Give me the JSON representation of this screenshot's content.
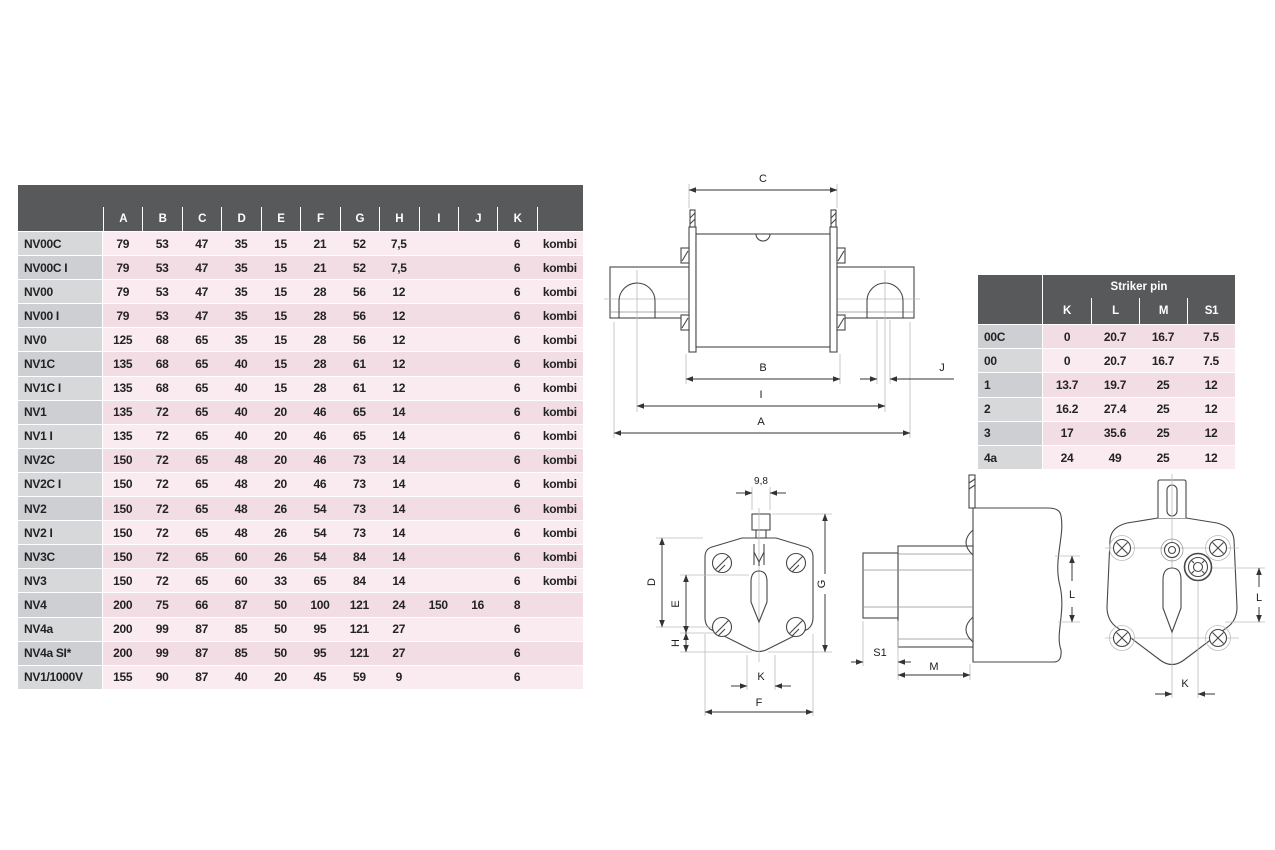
{
  "main_table": {
    "columns": [
      "A",
      "B",
      "C",
      "D",
      "E",
      "F",
      "G",
      "H",
      "I",
      "J",
      "K",
      ""
    ],
    "rows": [
      {
        "label": "NV00C",
        "cells": [
          "79",
          "53",
          "47",
          "35",
          "15",
          "21",
          "52",
          "7,5",
          "",
          "",
          "6",
          "kombi"
        ]
      },
      {
        "label": "NV00C I",
        "cells": [
          "79",
          "53",
          "47",
          "35",
          "15",
          "21",
          "52",
          "7,5",
          "",
          "",
          "6",
          "kombi"
        ]
      },
      {
        "label": "NV00",
        "cells": [
          "79",
          "53",
          "47",
          "35",
          "15",
          "28",
          "56",
          "12",
          "",
          "",
          "6",
          "kombi"
        ]
      },
      {
        "label": "NV00 I",
        "cells": [
          "79",
          "53",
          "47",
          "35",
          "15",
          "28",
          "56",
          "12",
          "",
          "",
          "6",
          "kombi"
        ]
      },
      {
        "label": "NV0",
        "cells": [
          "125",
          "68",
          "65",
          "35",
          "15",
          "28",
          "56",
          "12",
          "",
          "",
          "6",
          "kombi"
        ]
      },
      {
        "label": "NV1C",
        "cells": [
          "135",
          "68",
          "65",
          "40",
          "15",
          "28",
          "61",
          "12",
          "",
          "",
          "6",
          "kombi"
        ]
      },
      {
        "label": "NV1C I",
        "cells": [
          "135",
          "68",
          "65",
          "40",
          "15",
          "28",
          "61",
          "12",
          "",
          "",
          "6",
          "kombi"
        ]
      },
      {
        "label": "NV1",
        "cells": [
          "135",
          "72",
          "65",
          "40",
          "20",
          "46",
          "65",
          "14",
          "",
          "",
          "6",
          "kombi"
        ]
      },
      {
        "label": "NV1 I",
        "cells": [
          "135",
          "72",
          "65",
          "40",
          "20",
          "46",
          "65",
          "14",
          "",
          "",
          "6",
          "kombi"
        ]
      },
      {
        "label": "NV2C",
        "cells": [
          "150",
          "72",
          "65",
          "48",
          "20",
          "46",
          "73",
          "14",
          "",
          "",
          "6",
          "kombi"
        ]
      },
      {
        "label": "NV2C I",
        "cells": [
          "150",
          "72",
          "65",
          "48",
          "20",
          "46",
          "73",
          "14",
          "",
          "",
          "6",
          "kombi"
        ]
      },
      {
        "label": "NV2",
        "cells": [
          "150",
          "72",
          "65",
          "48",
          "26",
          "54",
          "73",
          "14",
          "",
          "",
          "6",
          "kombi"
        ]
      },
      {
        "label": "NV2 I",
        "cells": [
          "150",
          "72",
          "65",
          "48",
          "26",
          "54",
          "73",
          "14",
          "",
          "",
          "6",
          "kombi"
        ]
      },
      {
        "label": "NV3C",
        "cells": [
          "150",
          "72",
          "65",
          "60",
          "26",
          "54",
          "84",
          "14",
          "",
          "",
          "6",
          "kombi"
        ]
      },
      {
        "label": "NV3",
        "cells": [
          "150",
          "72",
          "65",
          "60",
          "33",
          "65",
          "84",
          "14",
          "",
          "",
          "6",
          "kombi"
        ]
      },
      {
        "label": "NV4",
        "cells": [
          "200",
          "75",
          "66",
          "87",
          "50",
          "100",
          "121",
          "24",
          "150",
          "16",
          "8",
          ""
        ]
      },
      {
        "label": "NV4a",
        "cells": [
          "200",
          "99",
          "87",
          "85",
          "50",
          "95",
          "121",
          "27",
          "",
          "",
          "6",
          ""
        ]
      },
      {
        "label": "NV4a SI*",
        "cells": [
          "200",
          "99",
          "87",
          "85",
          "50",
          "95",
          "121",
          "27",
          "",
          "",
          "6",
          ""
        ]
      },
      {
        "label": "NV1/1000V",
        "cells": [
          "155",
          "90",
          "87",
          "40",
          "20",
          "45",
          "59",
          "9",
          "",
          "",
          "6",
          ""
        ]
      }
    ]
  },
  "striker_table": {
    "title": "Striker pin",
    "columns": [
      "K",
      "L",
      "M",
      "S1"
    ],
    "rows": [
      {
        "label": "00C",
        "cells": [
          "0",
          "20.7",
          "16.7",
          "7.5"
        ]
      },
      {
        "label": "00",
        "cells": [
          "0",
          "20.7",
          "16.7",
          "7.5"
        ]
      },
      {
        "label": "1",
        "cells": [
          "13.7",
          "19.7",
          "25",
          "12"
        ]
      },
      {
        "label": "2",
        "cells": [
          "16.2",
          "27.4",
          "25",
          "12"
        ]
      },
      {
        "label": "3",
        "cells": [
          "17",
          "35.6",
          "25",
          "12"
        ]
      },
      {
        "label": "4a",
        "cells": [
          "24",
          "49",
          "25",
          "12"
        ]
      }
    ]
  },
  "drawings": {
    "front_view": {
      "labels": {
        "c": "C",
        "b": "B",
        "i": "I",
        "a": "A",
        "j": "J"
      }
    },
    "end_view": {
      "labels": {
        "width": "9,8",
        "d": "D",
        "e": "E",
        "h": "H",
        "g": "G",
        "k": "K",
        "f": "F"
      }
    },
    "side_view": {
      "labels": {
        "s1": "S1",
        "m": "M",
        "l": "L"
      }
    },
    "rear_view": {
      "labels": {
        "l": "L",
        "k": "K"
      }
    }
  },
  "colors": {
    "header_bg": "#58595b",
    "row_label_light": "#d7d8da",
    "row_label_dark": "#cdcfd2",
    "row_pink_light": "#f9ebf0",
    "row_pink_dark": "#f3dde5",
    "separator": "#ffffff",
    "line_dark": "#474747",
    "line_light": "#bcbcbc"
  }
}
